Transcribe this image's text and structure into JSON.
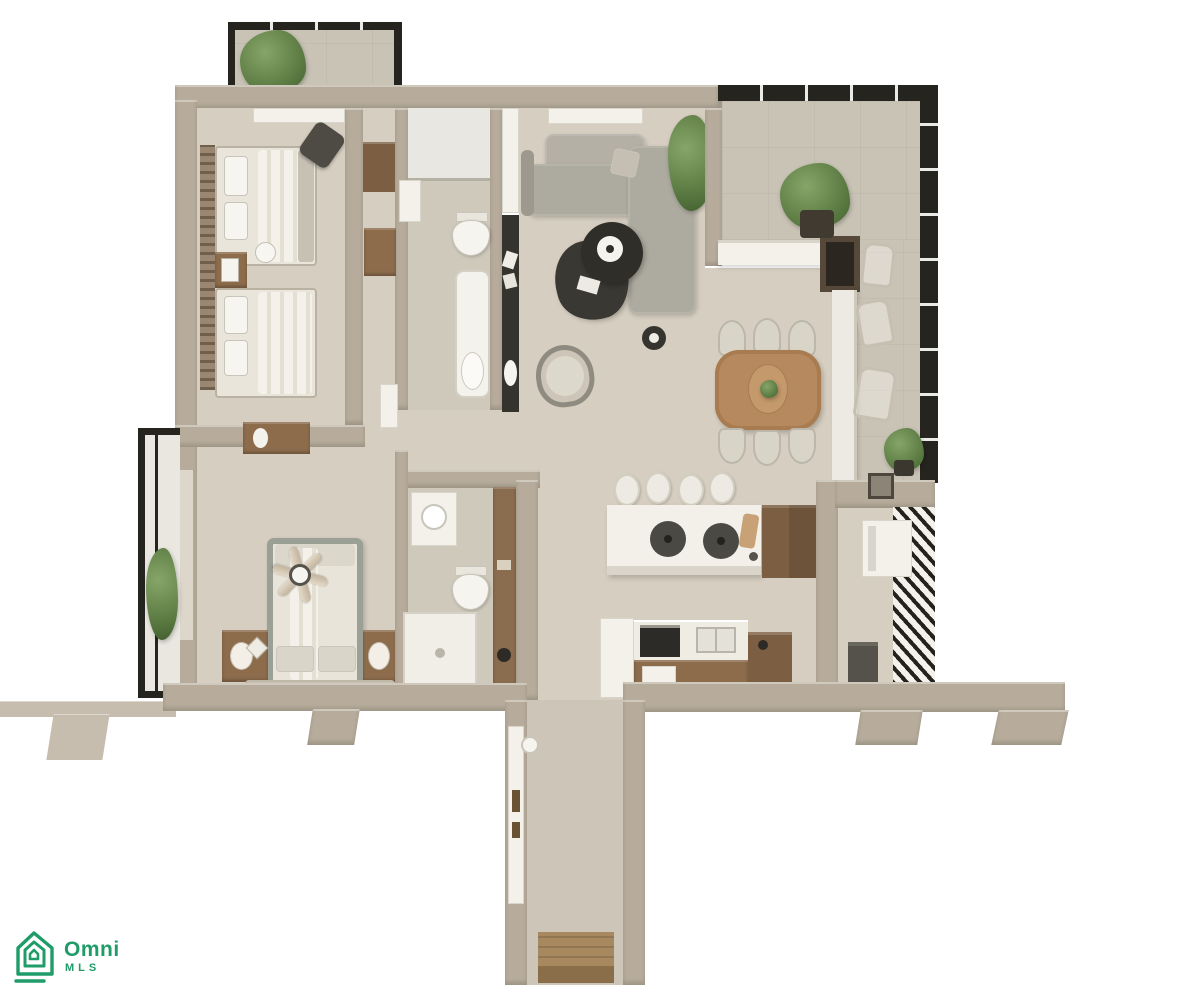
{
  "meta": {
    "type": "3d-floor-plan-top-down-render",
    "background": "#ffffff"
  },
  "watermark": {
    "brand": "Omni",
    "sub_brand": "MLS",
    "brand_color": "#1f9c68",
    "icon": "house-outline-icon"
  },
  "palette": {
    "wall": "#b7ac9b",
    "wall_light": "#c6bdae",
    "frame_black": "#26241e",
    "floor_main": "#d6cec0",
    "floor_bath": "#cfc9bc",
    "floor_terrace": "#c9c3b5",
    "floor_corridor": "#cdc6b8",
    "counter_white": "#f3f1ea",
    "wood": "#8d6c4c",
    "wood_table": "#b68a5e",
    "dark_furniture": "#35332d",
    "sofa_gray": "#adaa9f",
    "plant_green": "#5c7c44",
    "bed_frame_sage": "#9aa095"
  },
  "scene": {
    "rooms": [
      {
        "name": "top-balcony"
      },
      {
        "name": "twin-bedroom"
      },
      {
        "name": "closet-hall"
      },
      {
        "name": "bathroom-1"
      },
      {
        "name": "living-room"
      },
      {
        "name": "dining-area"
      },
      {
        "name": "terrace"
      },
      {
        "name": "kitchen"
      },
      {
        "name": "master-bedroom"
      },
      {
        "name": "master-bathroom"
      },
      {
        "name": "laundry-nook"
      },
      {
        "name": "entry-corridor"
      },
      {
        "name": "side-balcony"
      }
    ],
    "furniture": [
      "twin-bed",
      "twin-bed",
      "nightstand",
      "dresser",
      "l-shaped-sofa",
      "coffee-table-set",
      "armchair",
      "side-table",
      "console",
      "tv-console",
      "round-dining-table",
      "dining-chairs",
      "kitchen-island",
      "cooktop",
      "bar-stools",
      "pantry-cabinet",
      "fridge",
      "oven",
      "double-sink",
      "outdoor-bar",
      "outdoor-chairs",
      "potted-plants",
      "double-bed",
      "ceiling-fan",
      "nightstand-lamps",
      "vanity-sink",
      "toilet",
      "bathtub",
      "shower",
      "washer",
      "louvered-screen",
      "entry-door",
      "doormat"
    ]
  }
}
